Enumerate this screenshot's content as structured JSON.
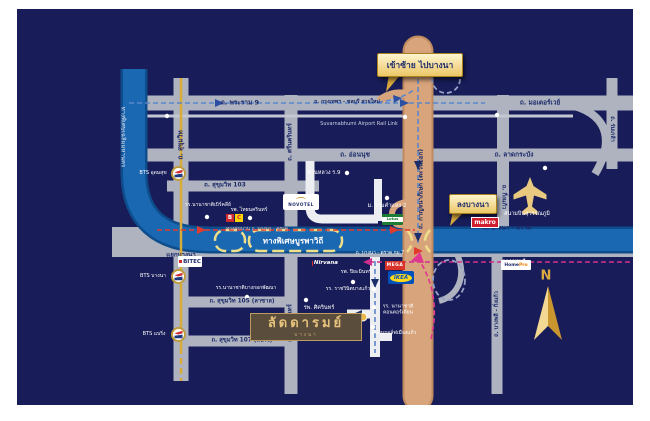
{
  "roads": {
    "rama9": "ถ. พระราม 9",
    "bkk_chonburi": "ถ. กรุงเทพฯ - ชลบุรี สายใหม่",
    "motorway": "ถ. มอเตอร์เวย์",
    "rail_link": "Suvarnabhumi Airport Rail Link",
    "onnut": "ถ. อ่อนนุช",
    "lat_krabang": "ถ. ลาดกระบัง",
    "sukhumvit": "ถ. สุขุมวิท",
    "srinakarin": "ถ. ศรีนครินทร์",
    "soi103": "ถ. สุขุมวิท 103",
    "soi105": "ถ. สุขุมวิท 105 (ลาซาล)",
    "soi107": "ถ. สุขุมวิท 107 (แบริ่ง)",
    "kingkaew": "ถ. กิ่งแก้ว",
    "romklao": "ถ. ร่มเกล้า",
    "kanchanaphisek": "ถ. กาญจนาภิเษก (ตะวันออก)",
    "bangphli_kingkaew": "ถ. บางพลี - กิ่งแก้ว",
    "bangna_trat": "ถ. บางนา - ตราด",
    "bangna_trat_km7": "ถ. บางนา - ตราด กม.7",
    "burapha_expwy": "ทางพิเศษบูรพาวิถี",
    "chalerm_expwy": "ทางพิเศษเฉลิมมหานคร",
    "frontage_road": "ทางคู่ขนาน ถ. บางนา - ตราด",
    "from_chonburi": "จากชลบุรี",
    "bangna_junction": "แยกบางนา"
  },
  "places": {
    "suanluang": "สวนหลวง ร.9",
    "ramkhamhaeng2": "ม. รามคำแหง 2",
    "berkeley": "รร.นานาชาติเบิร์คลีย์",
    "thainakarin": "รพ. ไทยนครินทร์",
    "patana": "รร.นานาชาติบางกอกพัฒนา",
    "sikarin": "รพ. ศิครินทร์",
    "piyamin": "รพ. ปิยะมินทร์",
    "ratwinit": "รร. ราชวินิตบางแก้ว",
    "concordian_1": "รร. นานาชาติ",
    "concordian_2": "คอนคอร์เดียน",
    "muangkaew_golf": "สนามกอล์ฟเมืองแก้ว",
    "suvarnabhumi": "สนามบินสุวรรณภูมิ"
  },
  "stations": {
    "udomsuk": "BTS อุดมสุข",
    "bangna": "BTS บางนา",
    "bearing": "BTS แบริ่ง"
  },
  "callouts": {
    "enter_left": "เข้าซ้าย ไปบางนา",
    "exit_bangna": "ลงบางนา"
  },
  "logos": {
    "bitec": "BITEC",
    "makro": "makro",
    "mega": "MEGA",
    "ikea": "IKEA",
    "novotel": "NOVOTEL",
    "homepro_1": "Home",
    "homepro_2": "Pro",
    "lotus": "Lotus",
    "nirvana": "Nirvana",
    "bigc_b": "B",
    "bigc_c": "C"
  },
  "project": {
    "name": "ลัดดารมย์",
    "sub": "บางนา"
  },
  "compass": {
    "north": "N"
  },
  "colors": {
    "background_navy": "#181c58",
    "expressway_blue": "#1a67b2",
    "ring_road_tan": "#d8a47c",
    "road_gray": "#aeb3bf",
    "bts_line_yellow": "#d9ac3a",
    "callout_yellow": "#ecc766",
    "gold": "#d9a93f",
    "route_red": "#e13a2e",
    "route_magenta": "#cf2f8e",
    "route_blue": "#5b86c9"
  }
}
